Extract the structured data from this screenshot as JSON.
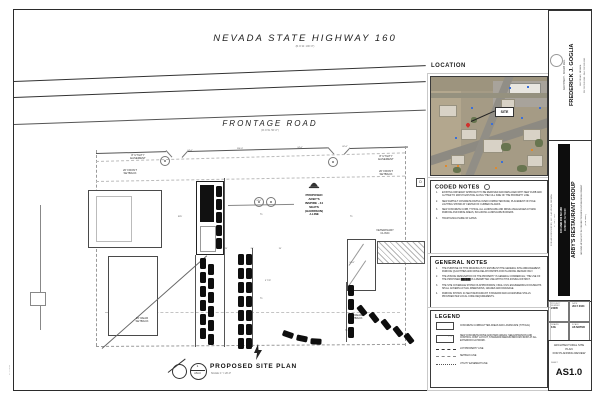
{
  "sheet": {
    "highway": {
      "title": "NEVADA STATE HIGHWAY 160",
      "subtitle": "(R.O.W. 100'-0\")"
    },
    "frontage": {
      "title": "FRONTAGE ROAD",
      "subtitle": "(R.O.W. 50'-0\")"
    },
    "plan_title": "PROPOSED SITE PLAN",
    "plan_scale": "SCALE: 1\" = 20'-0\"",
    "bubble_top": "1",
    "bubble_bottom": "AS1.0",
    "plot_stamp": "07.17.2024",
    "keynote_d": "D"
  },
  "plan": {
    "building_lines": [
      "PROPOSED",
      "ARBY'S",
      "INSPIRE - 44",
      "SEATS",
      "(HARRISON)",
      "J-LINE"
    ],
    "labels": [
      {
        "t": "8' UTILITY\nEASEMENT",
        "x": 138,
        "y": 154
      },
      {
        "t": "20' FRONT\nSETBACK",
        "x": 130,
        "y": 169
      },
      {
        "t": "8' UTILITY\nEASEMENT",
        "x": 386,
        "y": 155
      },
      {
        "t": "20' FRONT\nSETBACK",
        "x": 386,
        "y": 170
      },
      {
        "t": "VETERINARY\nCLINIC",
        "x": 385,
        "y": 229
      },
      {
        "t": "20' REAR\nSETBACK",
        "x": 142,
        "y": 317
      },
      {
        "t": "20' REAR\nSETBACK",
        "x": 356,
        "y": 314
      }
    ],
    "dims": [
      {
        "t": "24'-0\"",
        "x": 190,
        "y": 150
      },
      {
        "t": "110'-0\"",
        "x": 240,
        "y": 148
      },
      {
        "t": "24'-0\"",
        "x": 300,
        "y": 147
      },
      {
        "t": "62'-0\"",
        "x": 345,
        "y": 146
      },
      {
        "t": "24'-0\"",
        "x": 259,
        "y": 200
      },
      {
        "t": "R25'",
        "x": 180,
        "y": 216
      },
      {
        "t": "19'",
        "x": 226,
        "y": 248
      },
      {
        "t": "26'",
        "x": 252,
        "y": 248
      },
      {
        "t": "19'",
        "x": 280,
        "y": 248
      },
      {
        "t": "24'-0\"",
        "x": 352,
        "y": 262
      },
      {
        "t": "9' TYP",
        "x": 268,
        "y": 280
      }
    ]
  },
  "location": {
    "header": "LOCATION",
    "site_label": "SITE"
  },
  "coded_notes": {
    "header": "CODED NOTES",
    "items": [
      {
        "n": "1.",
        "t": "EXISTING DRIVEWAY APPROACH TO BE REMOVED AND REPLACED WITH NEW CURB AND GUTTER TO MATCH EXISTING ALONG THE FULL SIDE OF THE PROPERTY LINE."
      },
      {
        "n": "2.",
        "t": "NEW ASPHALT CONCRETE PAVING OVER COMPACTED BASE; PLACEMENT OF POLE LIGHTING SHOWN AT CENTER OF CURBED ISLANDS."
      },
      {
        "n": "3.",
        "t": "NEW CONCRETE CURB, TYPICAL ALL LANDSCAPE AND DRIVE AISLE EDGES AT NEW PARKING AND DRIVE AREAS, INCLUDING LANDSCAPE BUFFERS."
      },
      {
        "n": "4.",
        "t": "TRASH ENCLOSURE W/ GATES."
      }
    ]
  },
  "general_notes": {
    "header": "GENERAL NOTES",
    "items": [
      {
        "n": "1.",
        "t": "THE PURPOSE OF THIS DRAWING IS TO ESTABLISH THE GENERAL SITE ARRANGEMENT, PARKING QUANTITIES AND DRIVE RELATIONSHIPS FOR PLANNING REVIEW ONLY."
      },
      {
        "n": "2.",
        "t": "THE ZONING DESIGNATION OF THE PROPERTY IS GENERAL COMMERCIAL; THE USE OF THE PROPOSED ██████ IS A PERMITTED USE WITHIN THIS ZONING DISTRICT."
      },
      {
        "n": "3.",
        "t": "THE SITE COVERAGE SHOWN IS APPROXIMATE; FINAL CIVIL ENGINEERING DOCUMENTS SHALL GOVERN ACTUAL DIMENSIONS, GRADES AND DRAINAGE."
      },
      {
        "n": "4.",
        "t": "PARKING SHOWN: 44 SEAT RESTAURANT; STANDARD AND ACCESSIBLE STALLS PROVIDED PER LOCAL CODE REQUIREMENTS."
      }
    ]
  },
  "legend": {
    "header": "LEGEND",
    "items": [
      {
        "swatch": "rect",
        "label": "CONCRETE CURB/GUTTER AREAS AND LANDSCAPE (TYPICAL)"
      },
      {
        "swatch": "rect2",
        "label": "NEW CONCRETE DRIVE AND PARK AREAS; SEE EXPANSION AND CONTROL JOINT LAYOUT; STANDARD MEDIUM BROOM FINISH AT ALL EXTERIOR FLATWORK."
      },
      {
        "swatch": "dashdot",
        "label": "LOT/PROPERTY LINE"
      },
      {
        "swatch": "dash",
        "label": "SETBACK LINE"
      },
      {
        "swatch": "dot",
        "label": "UTILITY EASEMENT LINE"
      }
    ]
  },
  "titleblock": {
    "architect_name": "FREDERICK J. GOGLIA",
    "architect_title": "ARCHITECT · NCARB REG.",
    "architect_line1": "LAS VEGAS, NEVADA",
    "architect_line2": "PH 702.555.0160 · FAX 702.555.0161",
    "issue_date": "17 JULY, 2024",
    "project_name": "ARBY'S RESTAURANT GROUP",
    "project_sub1": "GROUND UP FACILITY IN CONJUNCTION W/ EXISTING DEVELOPMENT",
    "project_sub2": "(SITE ONLY)",
    "address1": "100 AND 200 NV-160",
    "address2": "PAHRUMP, NV 89048",
    "for_line": "FOR: ARG RESOURCES, LLC · LAS VEGAS, NEVADA",
    "fields": [
      {
        "label": "PROJECT NUMBER",
        "value": "24005"
      },
      {
        "label": "DATE",
        "value": "JULY 2024"
      },
      {
        "label": "DRAWN",
        "value": "FJG"
      },
      {
        "label": "SCALE",
        "value": "AS NOTED"
      }
    ],
    "sheet_title_lines": [
      "ARCHITECTURAL SITE",
      "PLAN",
      "FOR PLANNING REVIEW"
    ],
    "sheet_label": "SHEET",
    "sheet_number": "AS1.0"
  }
}
